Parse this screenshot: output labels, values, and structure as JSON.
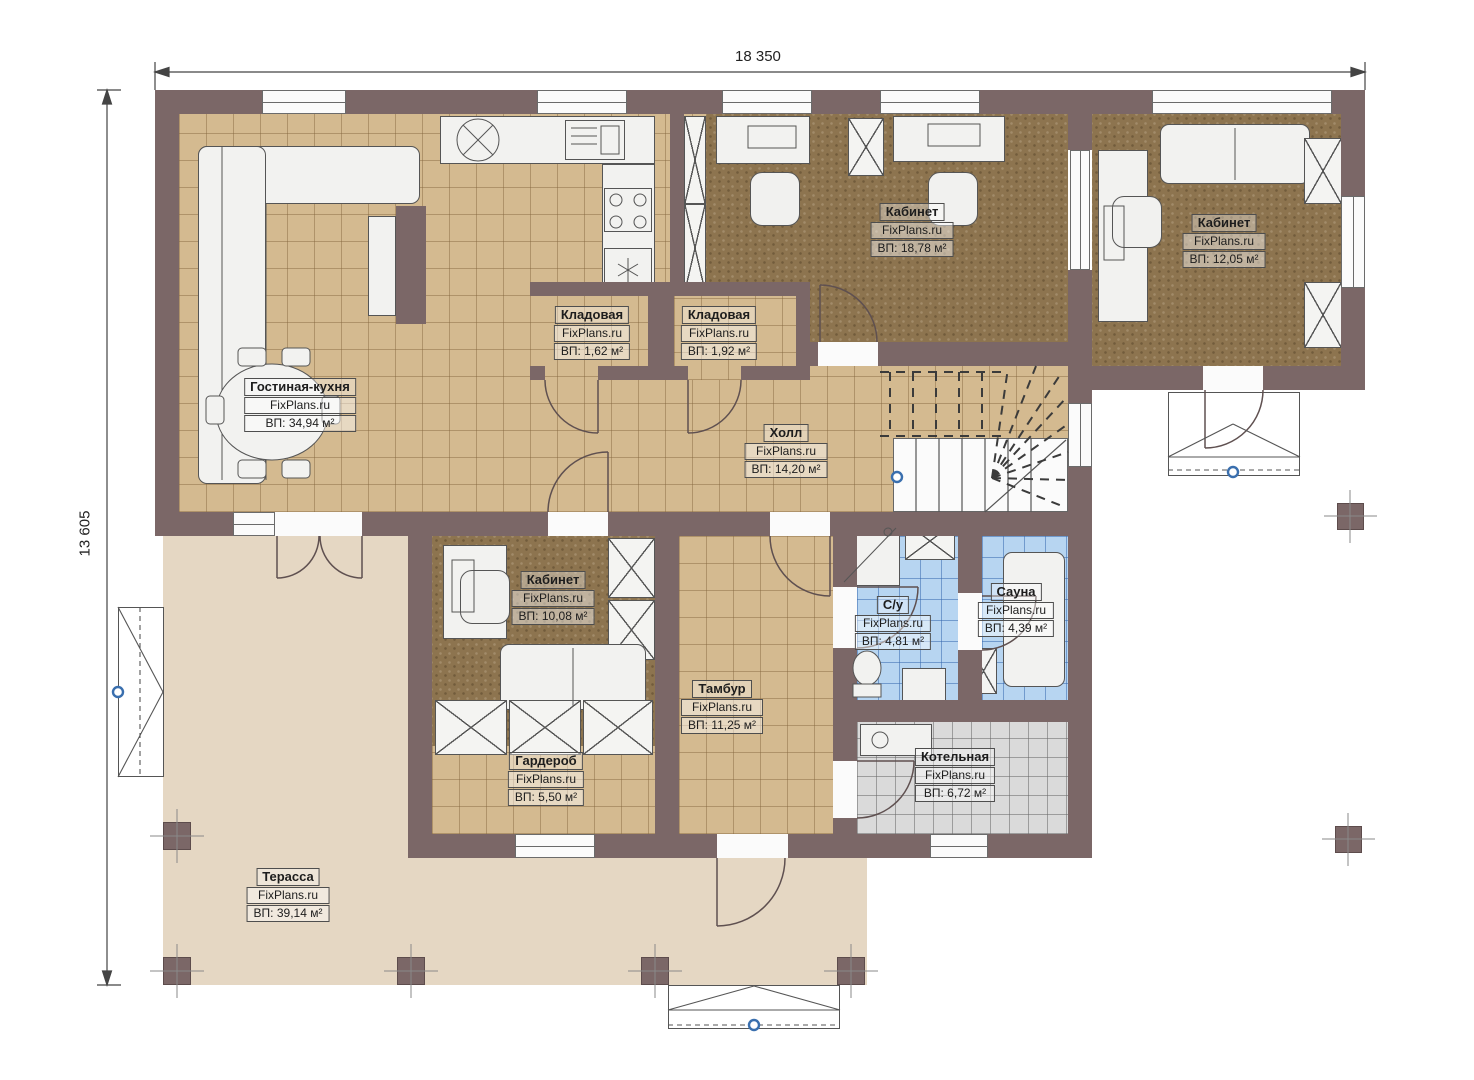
{
  "watermark": "FixPlans.ru",
  "dimensions": {
    "width_label": "18 350",
    "height_label": "13 605"
  },
  "rooms": [
    {
      "name": "Гостиная-кухня",
      "area": "ВП: 34,94 м²"
    },
    {
      "name": "Кабинет",
      "area": "ВП: 18,78 м²"
    },
    {
      "name": "Кабинет",
      "area": "ВП: 12,05 м²"
    },
    {
      "name": "Кладовая",
      "area": "ВП: 1,62 м²"
    },
    {
      "name": "Кладовая",
      "area": "ВП: 1,92 м²"
    },
    {
      "name": "Холл",
      "area": "ВП: 14,20 м²"
    },
    {
      "name": "Кабинет",
      "area": "ВП: 10,08 м²"
    },
    {
      "name": "С/у",
      "area": "ВП: 4,81 м²"
    },
    {
      "name": "Сауна",
      "area": "ВП: 4,39 м²"
    },
    {
      "name": "Тамбур",
      "area": "ВП: 11,25 м²"
    },
    {
      "name": "Гардероб",
      "area": "ВП: 5,50 м²"
    },
    {
      "name": "Котельная",
      "area": "ВП: 6,72 м²"
    },
    {
      "name": "Терасса",
      "area": "ВП: 39,14 м²"
    }
  ],
  "colors": {
    "wall": "#7b6767",
    "floor_tile": "#d4ba90",
    "floor_wood": "#8d744f",
    "floor_wet": "#b7d5f1",
    "floor_utility": "#dadada",
    "terrace": "#e5d7c3",
    "marker": "#3a6fae"
  }
}
